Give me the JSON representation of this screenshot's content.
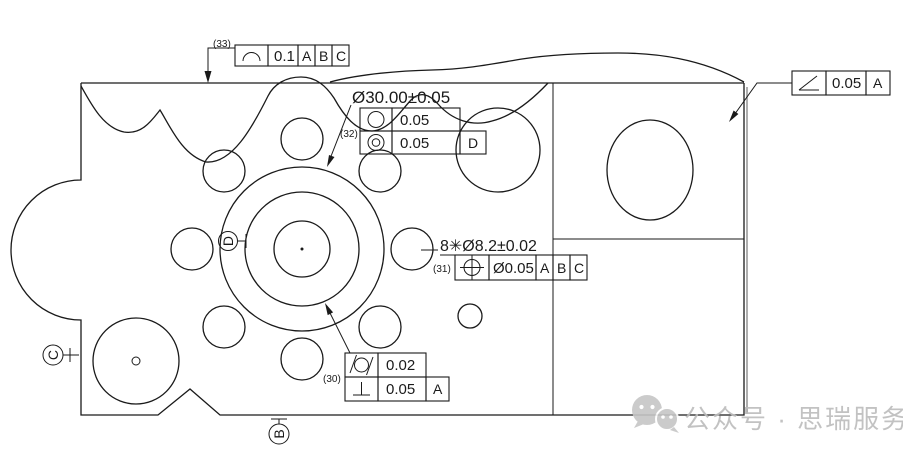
{
  "callouts": {
    "profile_label": "(33)",
    "profile_tol": "0.1",
    "profile_datum_1": "A",
    "profile_datum_2": "B",
    "profile_datum_3": "C",
    "bore_dim": "Ø30.00±0.05",
    "group32_label": "(32)",
    "circularity_tol": "0.05",
    "concentricity_tol": "0.05",
    "concentricity_datum": "D",
    "holes_dim": "8✳Ø8.2±0.02",
    "position_label": "(31)",
    "position_tol": "Ø0.05",
    "position_datum_1": "A",
    "position_datum_2": "B",
    "position_datum_3": "C",
    "group30_label": "(30)",
    "cylindricity_tol": "0.02",
    "perpendicularity_tol": "0.05",
    "perpendicularity_datum": "A",
    "angularity_tol": "0.05",
    "angularity_datum": "A"
  },
  "datums": {
    "b": "B",
    "c": "C",
    "d": "D"
  },
  "watermark": {
    "text": "公众号 · 思瑞服务"
  }
}
